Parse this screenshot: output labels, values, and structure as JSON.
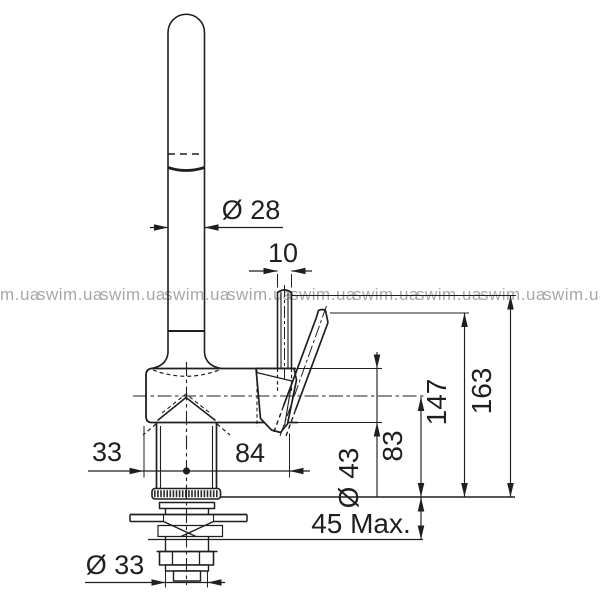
{
  "watermark": {
    "text": "swim.ua"
  },
  "dimensions": {
    "spout_diameter": "Ø 28",
    "handle_pin_diameter": "10",
    "total_height": "163",
    "handle_top_height": "147",
    "spout_axis_height": "83",
    "body_diameter": "Ø 43",
    "rear_offset": "33",
    "forward_offset": "84",
    "max_countertop_thickness": "45 Max.",
    "shank_diameter": "Ø 33"
  }
}
